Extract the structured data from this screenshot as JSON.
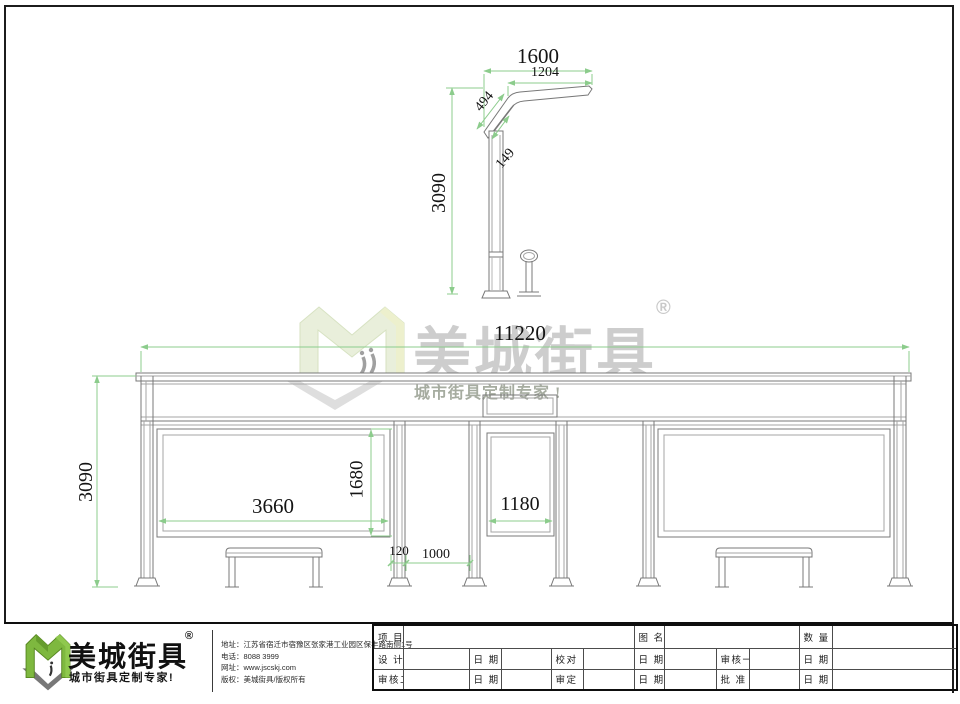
{
  "watermark": {
    "brand": "美城街具",
    "registered": "®",
    "slogan": "城市街具定制专家 !"
  },
  "side_view": {
    "dim_1600": "1600",
    "dim_1204": "1204",
    "dim_494": "494",
    "dim_149": "149",
    "dim_3090": "3090"
  },
  "front_view": {
    "dim_11220": "11220",
    "dim_3090": "3090",
    "dim_3660": "3660",
    "dim_1680": "1680",
    "dim_1180": "1180",
    "dim_120": "120",
    "dim_1000": "1000"
  },
  "colors": {
    "dimension_green": "#8ccc8c",
    "logo_green": "#7eb83f",
    "watermark_gray": "#cdcdcd"
  },
  "footer": {
    "logo": {
      "brand": "美城街具",
      "registered": "®",
      "slogan": "城市街具定制专家!"
    },
    "contact": {
      "address": "地址：江苏省宿迁市宿豫区张家港工业园区保丰路南侧1号",
      "phone": "电话：8088 3999",
      "website": "网址：www.jscskj.com",
      "copyright": "版权：美城街具/版权所有"
    },
    "titleblock": {
      "project": "项 目",
      "drawing_name": "图 名",
      "quantity": "数 量",
      "design": "设 计",
      "date": "日 期",
      "proofread": "校对",
      "reviewer1": "审核一",
      "reviewer2": "审核二",
      "approve": "审定",
      "ratify": "批 准"
    }
  }
}
